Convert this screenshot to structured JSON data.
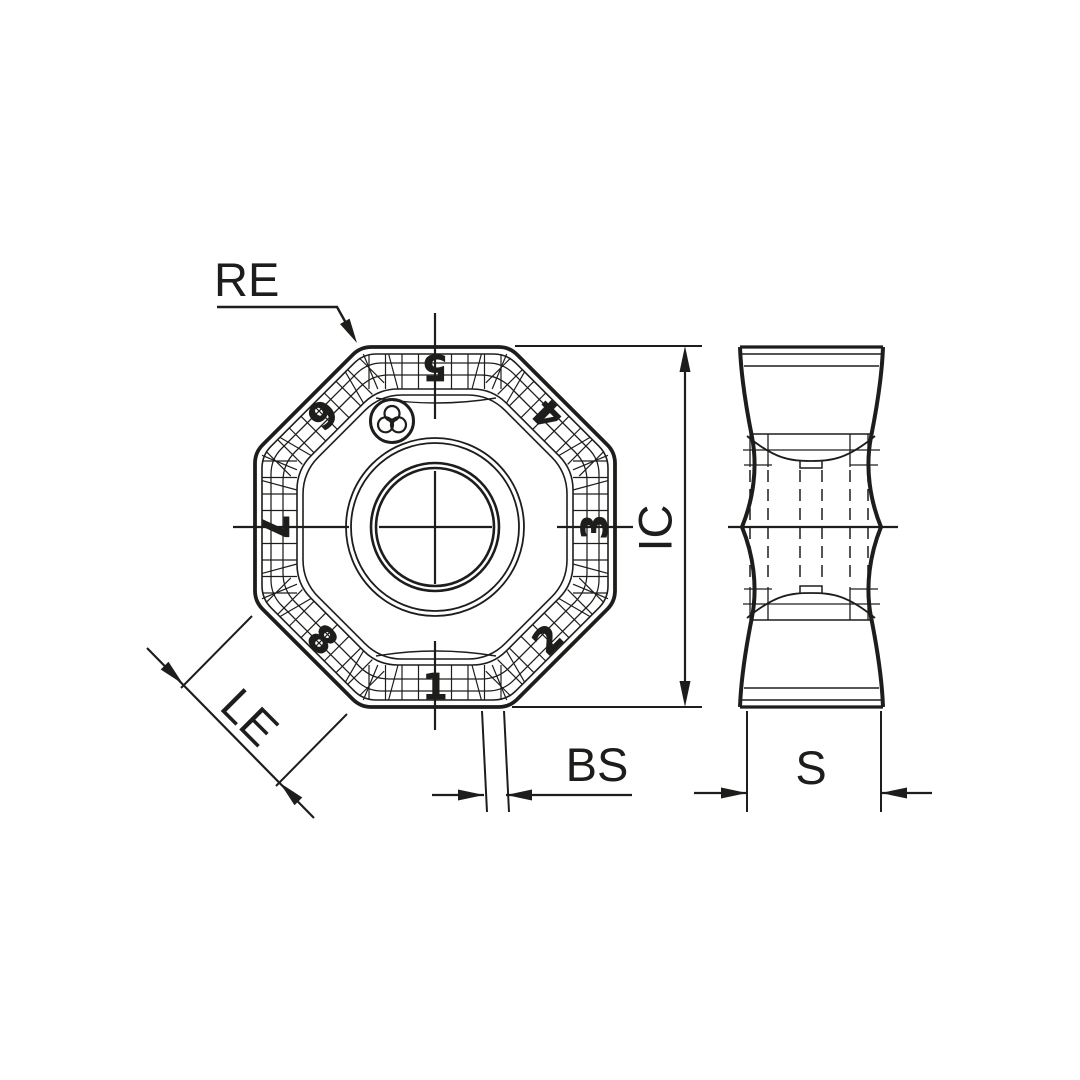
{
  "labels": {
    "re": "RE",
    "ic": "IC",
    "bs": "BS",
    "le": "LE",
    "s": "S"
  },
  "edge_numbers": [
    "1",
    "2",
    "3",
    "4",
    "5",
    "6",
    "7",
    "8"
  ],
  "colors": {
    "ink": "#1d1d1b",
    "background": "#ffffff"
  }
}
